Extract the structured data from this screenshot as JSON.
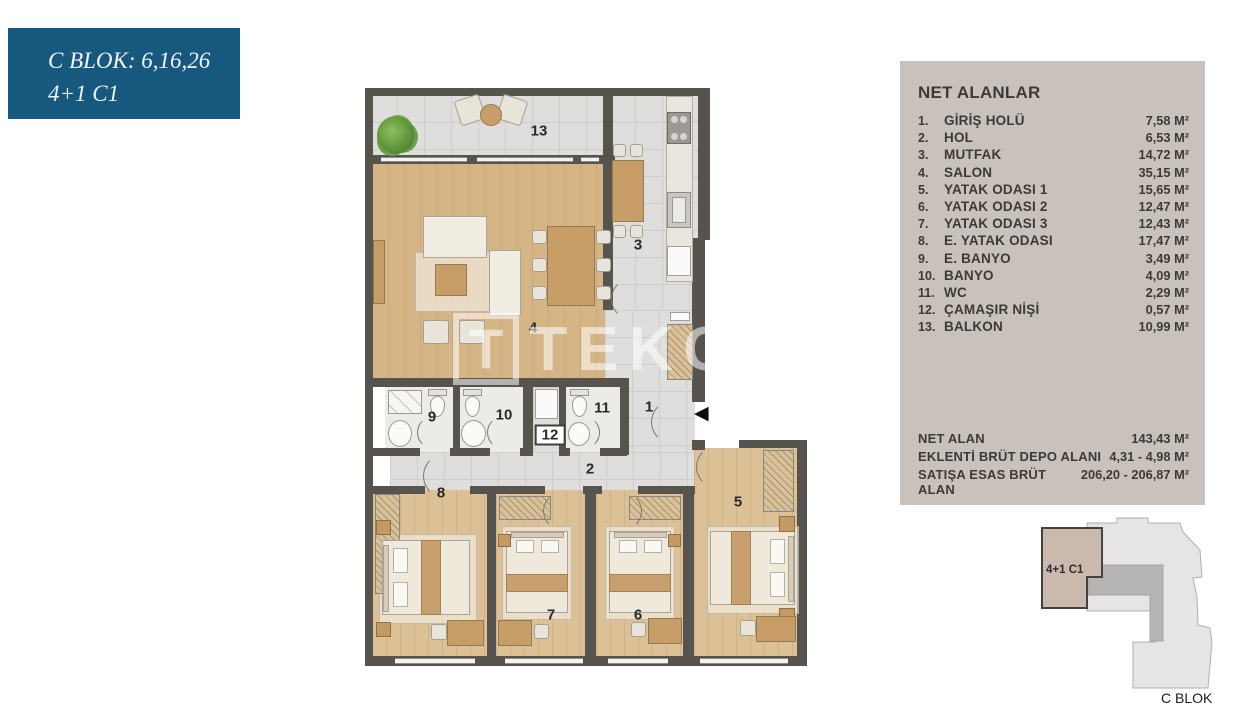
{
  "badge": {
    "line1": "C BLOK: 6,16,26",
    "line2": "4+1 C1"
  },
  "panel": {
    "title": "NET ALANLAR",
    "items": [
      {
        "num": "1.",
        "label": "GİRİŞ HOLÜ",
        "value": "7,58 M²"
      },
      {
        "num": "2.",
        "label": "HOL",
        "value": "6,53 M²"
      },
      {
        "num": "3.",
        "label": "MUTFAK",
        "value": "14,72 M²"
      },
      {
        "num": "4.",
        "label": "SALON",
        "value": "35,15 M²"
      },
      {
        "num": "5.",
        "label": "YATAK ODASI 1",
        "value": "15,65 M²"
      },
      {
        "num": "6.",
        "label": "YATAK ODASI 2",
        "value": "12,47 M²"
      },
      {
        "num": "7.",
        "label": "YATAK ODASI 3",
        "value": "12,43 M²"
      },
      {
        "num": "8.",
        "label": "E. YATAK ODASI",
        "value": "17,47 M²"
      },
      {
        "num": "9.",
        "label": "E. BANYO",
        "value": "3,49 M²"
      },
      {
        "num": "10.",
        "label": "BANYO",
        "value": "4,09 M²"
      },
      {
        "num": "11.",
        "label": "WC",
        "value": "2,29 M²"
      },
      {
        "num": "12.",
        "label": "ÇAMAŞIR NİŞİ",
        "value": "0,57 M²"
      },
      {
        "num": "13.",
        "label": "BALKON",
        "value": "10,99 M²"
      }
    ],
    "summary": [
      {
        "label": "NET ALAN",
        "value": "143,43 M²"
      },
      {
        "label": "EKLENTİ BRÜT DEPO ALANI",
        "value": "4,31 - 4,98 M²"
      },
      {
        "label": "SATIŞA ESAS BRÜT ALAN",
        "value": "206,20 - 206,87 M²"
      }
    ]
  },
  "plan": {
    "watermark_t": "T",
    "watermark": "TEKCE",
    "entry_arrow": "◀",
    "rooms": [
      {
        "id": "giris-holu",
        "num": "1",
        "name": "GİRİŞ HOLÜ"
      },
      {
        "id": "hol",
        "num": "2",
        "name": "HOL"
      },
      {
        "id": "mutfak",
        "num": "3",
        "name": "MUTFAK"
      },
      {
        "id": "salon",
        "num": "4",
        "name": "SALON"
      },
      {
        "id": "yatak-odasi-1",
        "num": "5",
        "name": "YATAK ODASI 1"
      },
      {
        "id": "yatak-odasi-2",
        "num": "6",
        "name": "YATAK ODASI 2"
      },
      {
        "id": "yatak-odasi-3",
        "num": "7",
        "name": "YATAK ODASI 3"
      },
      {
        "id": "e-yatak-odasi",
        "num": "8",
        "name": "E. YATAK ODASI"
      },
      {
        "id": "e-banyo",
        "num": "9",
        "name": "E. BANYO"
      },
      {
        "id": "banyo",
        "num": "10",
        "name": "BANYO"
      },
      {
        "id": "wc",
        "num": "11",
        "name": "WC"
      },
      {
        "id": "camasir-nisi",
        "num": "12",
        "name": "ÇAMAŞIR NİŞİ"
      },
      {
        "id": "balkon",
        "num": "13",
        "name": "BALKON"
      }
    ]
  },
  "keyplan": {
    "unit_label": "4+1 C1",
    "block_label": "C BLOK"
  },
  "colors": {
    "badge_bg": "#17587e",
    "panel_bg": "#c9c2bc",
    "wall": "#57544f",
    "wood": "#d5b586",
    "wood_bed": "#dcc096",
    "tile": "#dfdedc",
    "bath": "#edebe8",
    "unit_fill": "#cbb9ae"
  }
}
